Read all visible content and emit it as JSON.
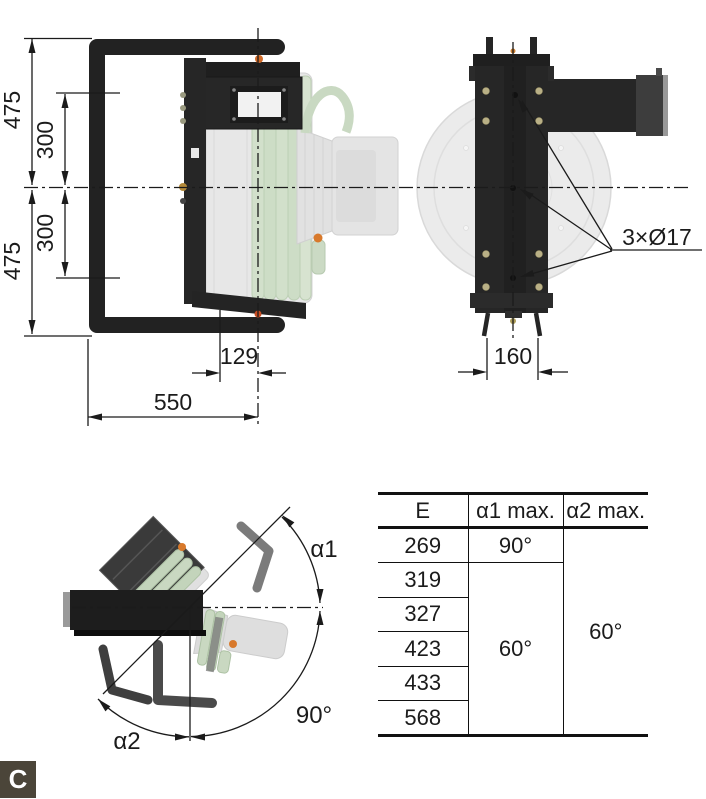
{
  "drawing": {
    "front_view": {
      "dim_475_top": "475",
      "dim_300_top": "300",
      "dim_300_bottom": "300",
      "dim_475_bottom": "475",
      "dim_129": "129",
      "dim_550": "550"
    },
    "side_view": {
      "dim_160": "160",
      "holes_label": "3×Ø17"
    },
    "rotation_view": {
      "alpha1_label": "α1",
      "alpha2_label": "α2",
      "angle_90_label": "90°"
    }
  },
  "table": {
    "headers": [
      "E",
      "α1 max.",
      "α2 max."
    ],
    "e_values": [
      "269",
      "319",
      "327",
      "423",
      "433",
      "568"
    ],
    "alpha1_first": "90°",
    "alpha1_rest": "60°",
    "alpha2_all": "60°"
  },
  "section_label": "C",
  "colors": {
    "ink": "#1b1b1b",
    "machine_black": "#242424",
    "ghost_gray": "#e7e7e7",
    "hose_green": "#cdddc6",
    "accent_orange": "#d8792b",
    "badge_bg": "#4b4539"
  }
}
